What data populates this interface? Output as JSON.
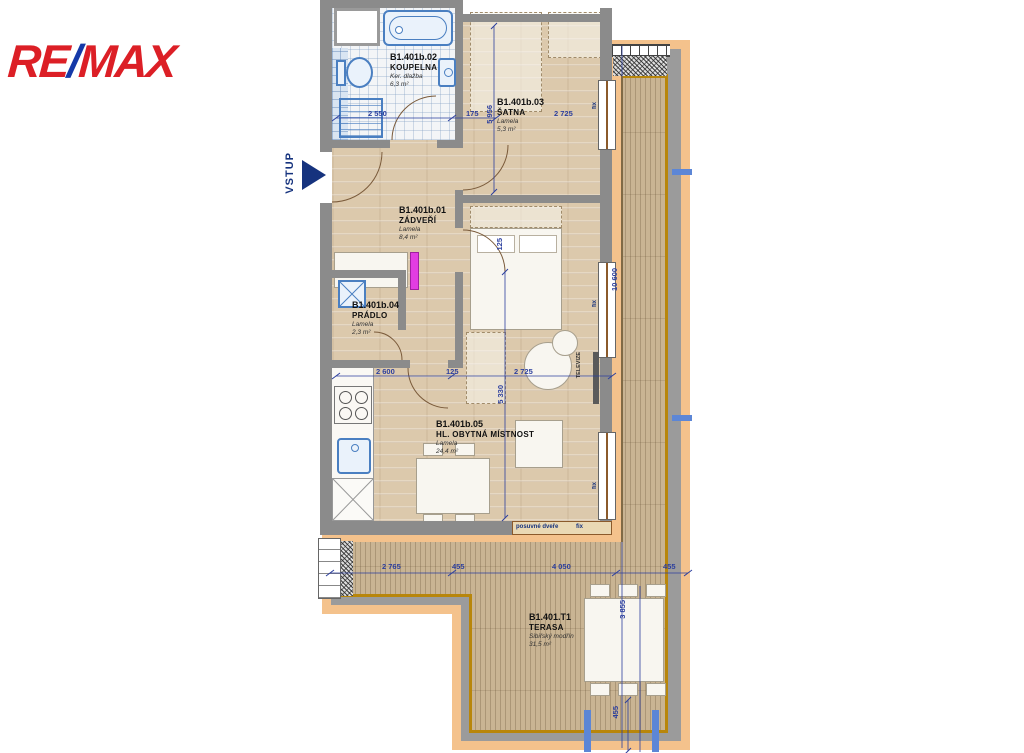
{
  "brand": {
    "re": "RE",
    "slash": "/",
    "max": "MAX"
  },
  "annotations": {
    "entrance": "VSTUP",
    "sliding_door": "posuvné dveře",
    "fix": "fix",
    "tv": "TELEVIZE"
  },
  "rooms": [
    {
      "code": "B1.401b.01",
      "name": "ZÁDVEŘÍ",
      "material": "Lamela",
      "area": "8,4 m²"
    },
    {
      "code": "B1.401b.02",
      "name": "KOUPELNA",
      "material": "Ker. dlažba",
      "area": "6,3 m²"
    },
    {
      "code": "B1.401b.03",
      "name": "ŠATNA",
      "material": "Lamela",
      "area": "5,3 m²"
    },
    {
      "code": "B1.401b.04",
      "name": "PRÁDLO",
      "material": "Lamela",
      "area": "2,3 m²"
    },
    {
      "code": "B1.401b.05",
      "name": "HL. OBYTNÁ MÍSTNOST",
      "material": "Lamela",
      "area": "24,4 m²"
    },
    {
      "code": "B1.401.T1",
      "name": "TERASA",
      "material": "Sibiřský modřín",
      "area": "31,5 m²"
    }
  ],
  "dims": [
    {
      "text": "2 550"
    },
    {
      "text": "175"
    },
    {
      "text": "2 725"
    },
    {
      "text": "5 956"
    },
    {
      "text": "125"
    },
    {
      "text": "2 600"
    },
    {
      "text": "125"
    },
    {
      "text": "2 725"
    },
    {
      "text": "5 330"
    },
    {
      "text": "10 600"
    },
    {
      "text": "2 765"
    },
    {
      "text": "455"
    },
    {
      "text": "4 050"
    },
    {
      "text": "455"
    },
    {
      "text": "3 855"
    },
    {
      "text": "455"
    }
  ],
  "colors": {
    "logo_red": "#dc1f26",
    "logo_blue": "#1539a8",
    "dimension_blue": "#2c3f9e",
    "wall_gray": "#8b8b8b",
    "facade_orange": "#f4c28c",
    "deck_wood": "#c9b493",
    "interior_wood": "#dcc9ac",
    "terrace_border_gold": "#b8860b"
  }
}
